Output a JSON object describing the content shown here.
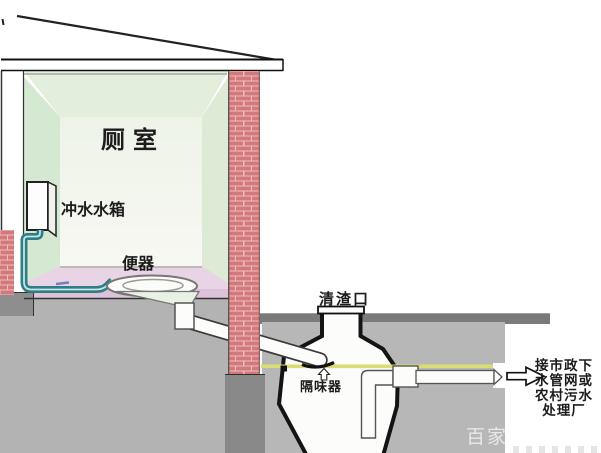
{
  "diagram": {
    "room_label": "厕室",
    "flush_tank_label": "冲水水箱",
    "toilet_label": "便器",
    "cleanout_label": "清渣口",
    "odor_trap_label": "隔味器",
    "outlet_note": [
      "接市政下",
      "水管网或",
      "农村污水",
      "处理厂"
    ],
    "watermark": "百家号",
    "colors": {
      "brick": "#d4797b",
      "brick_mortar": "#edbebe",
      "wall_green": "#d5e8d2",
      "ceiling_green": "#e3efdc",
      "back_wall": "#f3f6ee",
      "floor_pink": "#e9d4e6",
      "ground_gray": "#b3b3b3",
      "ground_surface_band": "#7a7a7a",
      "foundation_gray": "#898989",
      "pipe_teal": "#2e7f85",
      "water_line_yellow": "#d9dd72"
    }
  }
}
